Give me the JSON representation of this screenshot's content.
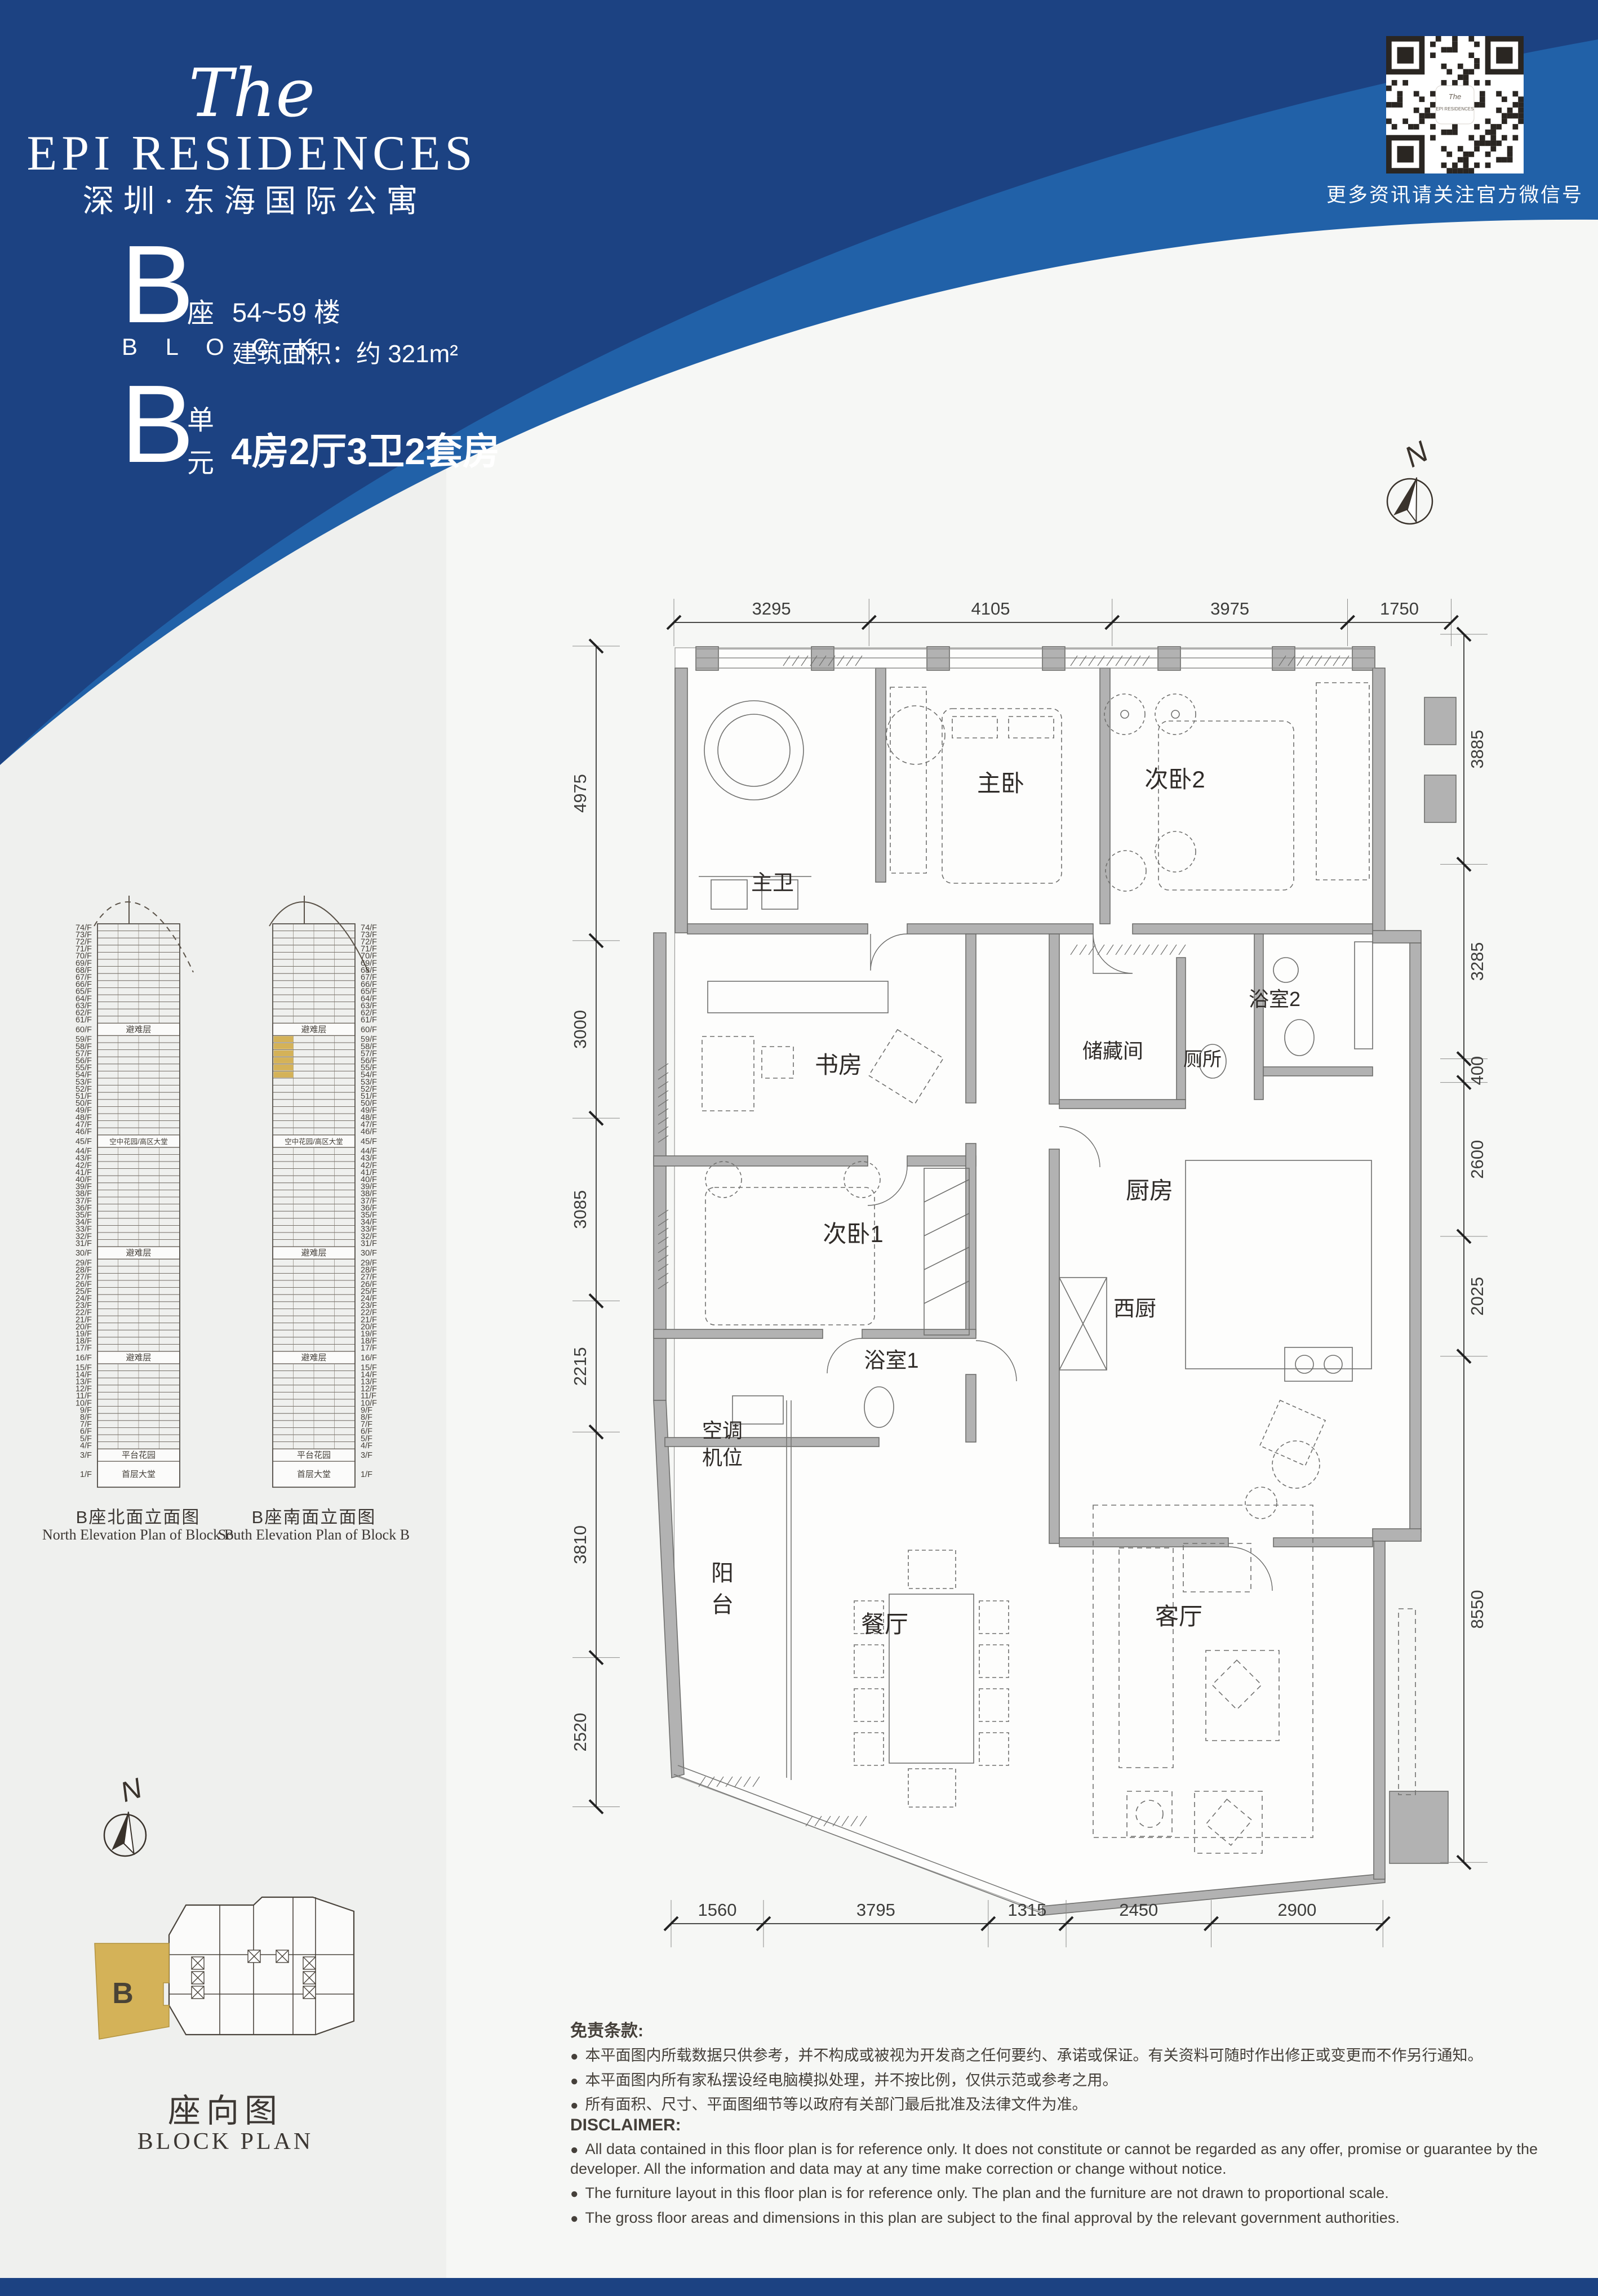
{
  "colors": {
    "navy": "#1C4282",
    "blue": "#2161A8",
    "gold": "#D4B258",
    "wall": "#b2b2b2",
    "ink": "#45403a"
  },
  "logo": {
    "script": "The",
    "name": "EPI  RESIDENCES",
    "subtitle": "深圳·东海国际公寓"
  },
  "block_info": {
    "block_letter": "B",
    "block_zh": "座",
    "block_en": "B L O C K",
    "floors_range": "54~59 楼",
    "area": "建筑面积：约 321m²",
    "unit_letter": "B",
    "unit_zh_top": "单",
    "unit_zh_bottom": "元",
    "unit_desc": "4房2厅3卫2套房"
  },
  "qr": {
    "caption": "更多资讯请关注官方微信号",
    "logo_script": "The",
    "logo_line": "EPI RESIDENCES"
  },
  "compass_label": "N",
  "floorplan": {
    "rooms": {
      "master_bed": "主卧",
      "bed2": "次卧2",
      "master_bath": "主卫",
      "study": "书房",
      "storage": "储藏间",
      "toilet": "厕所",
      "bath2": "浴室2",
      "kitchen": "厨房",
      "west_kitchen": "西厨",
      "bed1": "次卧1",
      "bath1": "浴室1",
      "ac_line1": "空调",
      "ac_line2": "机位",
      "balcony": "阳台",
      "dining": "餐厅",
      "living": "客厅"
    },
    "dims_top": [
      "3295",
      "4105",
      "3975",
      "1750"
    ],
    "dims_bottom": [
      "1560",
      "3795",
      "1315",
      "2450",
      "2900"
    ],
    "dims_left": [
      "4975",
      "3000",
      "3085",
      "2215",
      "3810",
      "2520"
    ],
    "dims_right": [
      "3885",
      "3285",
      "400",
      "2600",
      "2025",
      "8550"
    ]
  },
  "elevations": {
    "north": {
      "title": "B座北面立面图",
      "subtitle": "North Elevation Plan of Block B"
    },
    "south": {
      "title": "B座南面立面图",
      "subtitle": "South Elevation Plan of Block B"
    },
    "floor_suffix": "/F",
    "top_floor": 74,
    "bottom_floor": 1,
    "band_labels": {
      "60": "避难层",
      "45": "空中花园/高区大堂",
      "30": "避难层",
      "16": "避难层",
      "3": "平台花园",
      "1": "首层大堂"
    },
    "highlight_floors": [
      54,
      55,
      56,
      57,
      58,
      59
    ]
  },
  "blockplan": {
    "title": "座向图",
    "subtitle": "BLOCK PLAN",
    "unit_label": "B"
  },
  "disclaimer_zh": {
    "title": "免责条款:",
    "items": [
      "本平面图内所载数据只供参考，并不构成或被视为开发商之任何要约、承诺或保证。有关资料可随时作出修正或变更而不作另行通知。",
      "本平面图内所有家私摆设经电脑模拟处理，并不按比例，仅供示范或参考之用。",
      "所有面积、尺寸、平面图细节等以政府有关部门最后批准及法律文件为准。"
    ]
  },
  "disclaimer_en": {
    "title": "DISCLAIMER:",
    "items": [
      "All data contained in this floor plan is for reference only. It does not constitute or cannot be regarded as any offer, promise or guarantee by the developer. All the information and data may at any time make correction or change without notice.",
      "The furniture layout in this floor plan is for reference only. The plan and the furniture are not drawn to proportional scale.",
      "The gross floor areas and dimensions in this plan are subject to the final approval by the relevant government authorities."
    ]
  }
}
